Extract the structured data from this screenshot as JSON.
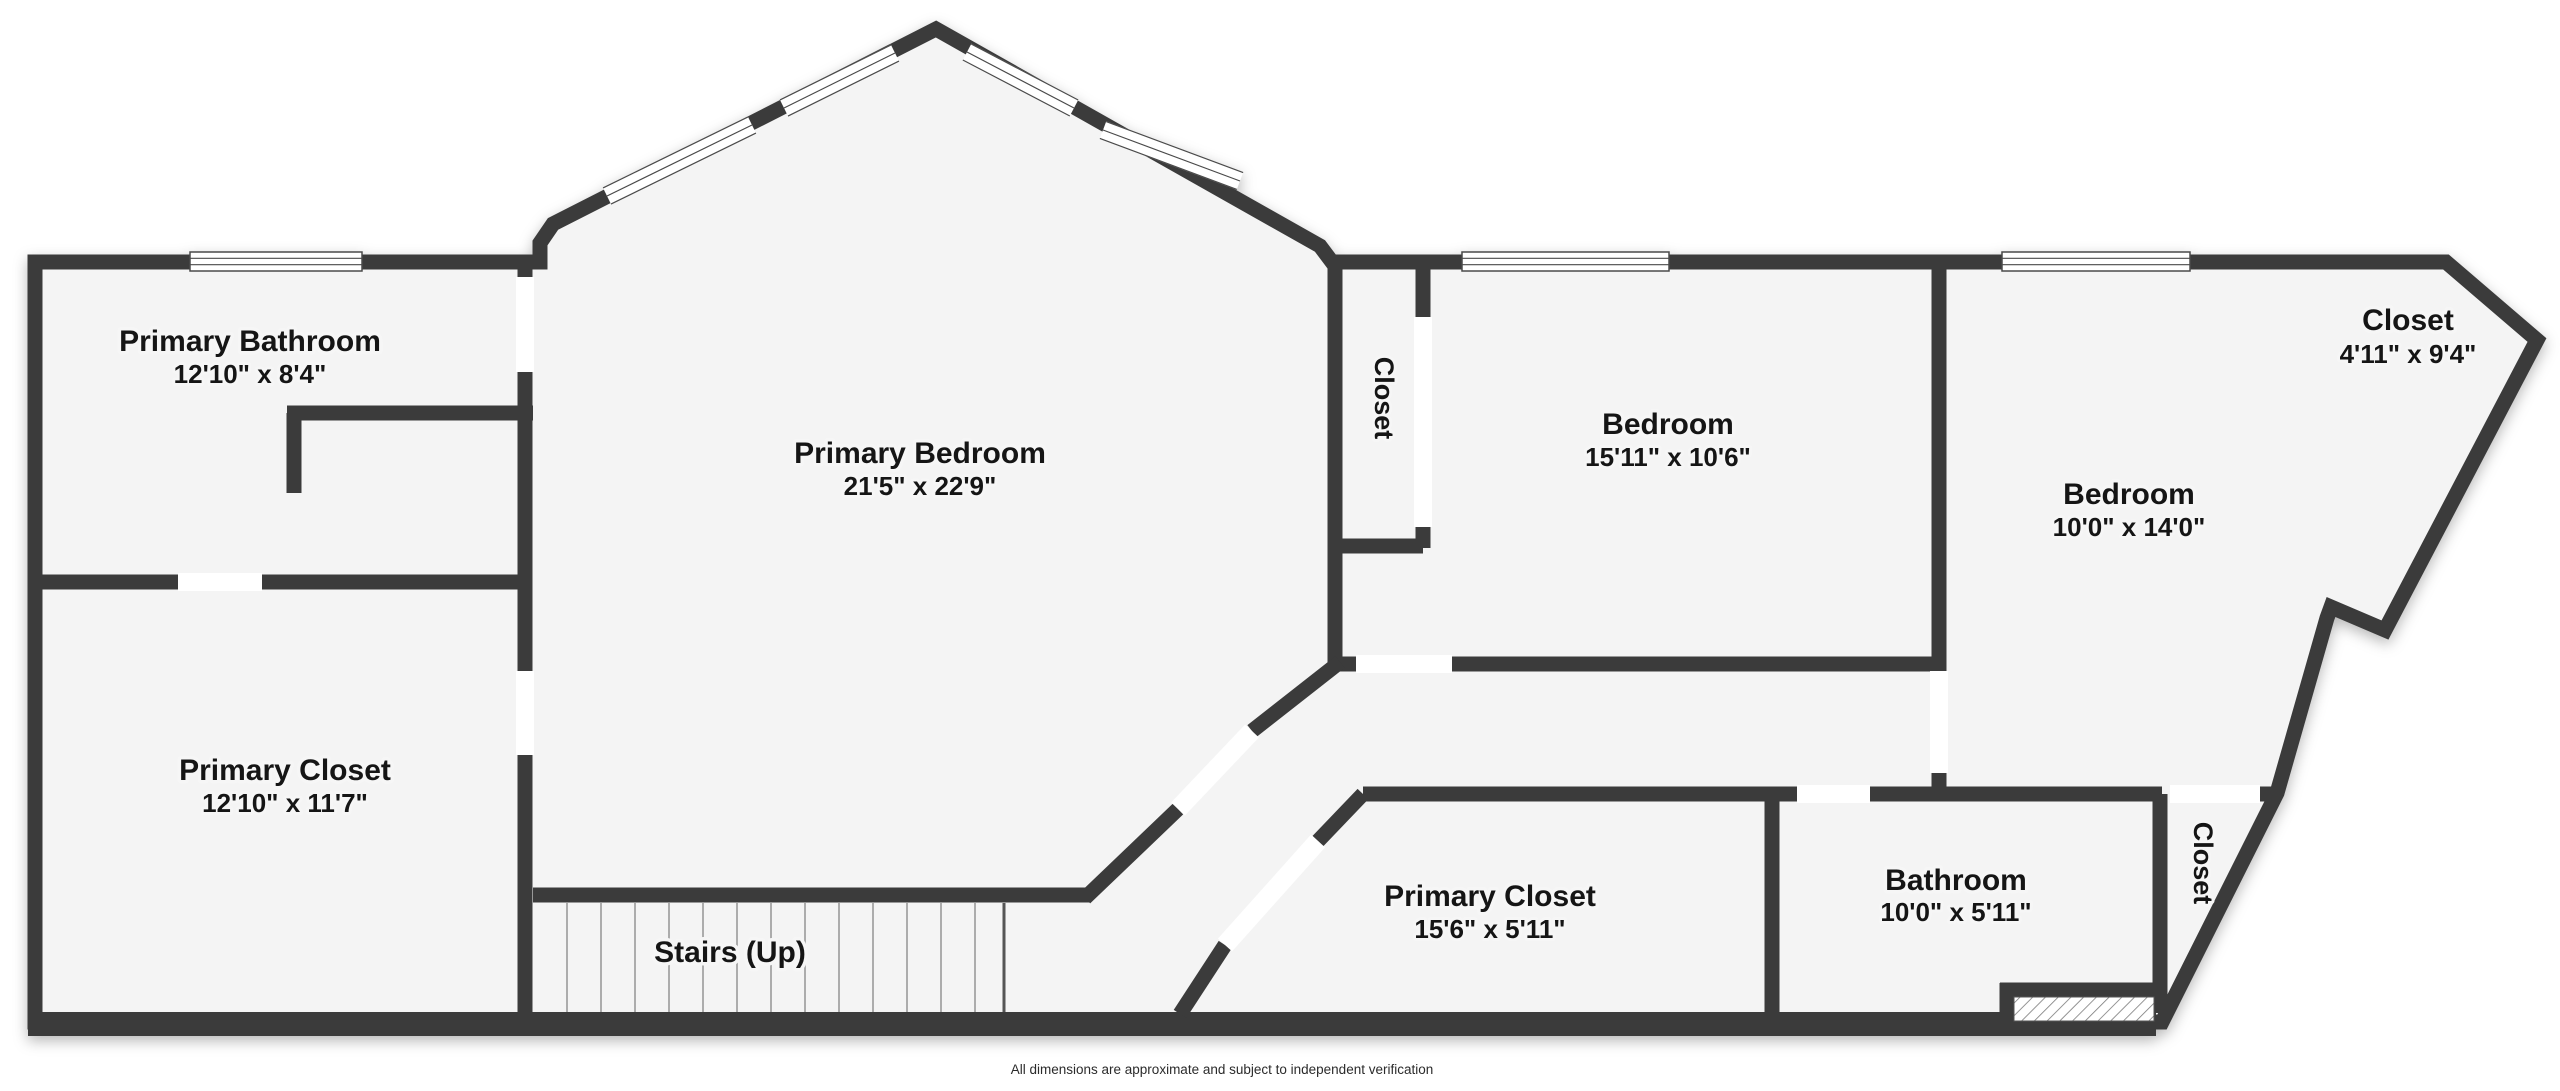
{
  "disclaimer": "All dimensions are approximate and subject to independent verification",
  "colors": {
    "background": "#ffffff",
    "floor": "#f4f4f4",
    "wall": "#3b3b3b",
    "window_line": "#4a4a4a",
    "tread_line": "#9a9a9a",
    "hatch_line": "#7a7a7a",
    "text": "#151515"
  },
  "rooms": [
    {
      "id": "primary-bathroom",
      "name": "Primary Bathroom",
      "dims": "12'10\" x 8'4\"",
      "x": 250,
      "y": 351,
      "dims_y": 383,
      "vertical": false
    },
    {
      "id": "primary-bedroom",
      "name": "Primary Bedroom",
      "dims": "21'5\" x 22'9\"",
      "x": 920,
      "y": 463,
      "dims_y": 495,
      "vertical": false
    },
    {
      "id": "primary-closet",
      "name": "Primary Closet",
      "dims": "12'10\" x 11'7\"",
      "x": 285,
      "y": 780,
      "dims_y": 812,
      "vertical": false
    },
    {
      "id": "stairs",
      "name": "Stairs (Up)",
      "dims": null,
      "x": 730,
      "y": 962,
      "dims_y": null,
      "vertical": false
    },
    {
      "id": "closet-hall",
      "name": "Closet",
      "dims": null,
      "x": 1375,
      "y": 398,
      "dims_y": null,
      "vertical": true
    },
    {
      "id": "bedroom-1",
      "name": "Bedroom",
      "dims": "15'11\" x 10'6\"",
      "x": 1668,
      "y": 434,
      "dims_y": 466,
      "vertical": false
    },
    {
      "id": "bedroom-2",
      "name": "Bedroom",
      "dims": "10'0\" x 14'0\"",
      "x": 2129,
      "y": 504,
      "dims_y": 536,
      "vertical": false
    },
    {
      "id": "closet-ne",
      "name": "Closet",
      "dims": "4'11\" x 9'4\"",
      "x": 2408,
      "y": 330,
      "dims_y": 363,
      "vertical": false
    },
    {
      "id": "bathroom",
      "name": "Bathroom",
      "dims": "10'0\" x 5'11\"",
      "x": 1956,
      "y": 890,
      "dims_y": 921,
      "vertical": false
    },
    {
      "id": "primary-closet-2",
      "name": "Primary Closet",
      "dims": "15'6\" x 5'11\"",
      "x": 1490,
      "y": 906,
      "dims_y": 938,
      "vertical": false
    },
    {
      "id": "closet-se",
      "name": "Closet",
      "dims": null,
      "x": 2194,
      "y": 863,
      "vertical": true
    }
  ],
  "floorplan": {
    "canvas": {
      "width": 2560,
      "height": 1091
    },
    "wall_width": 15,
    "outline": "M 35 262 L 540 262 L 540 243 L 553 224 L 936 29 L 1320 246 L 1332 262 L 2446 262 L 2537 340 L 2385 630 L 2331 607 L 2327 618 L 2277 793 L 2162 1022 L 35 1022 Z",
    "bottom_wall": {
      "x": 28,
      "y": 1012,
      "w": 2128,
      "h": 24
    },
    "walls": [
      {
        "x1": 525,
        "y1": 262,
        "x2": 525,
        "y2": 277
      },
      {
        "x1": 525,
        "y1": 372,
        "x2": 525,
        "y2": 671
      },
      {
        "x1": 525,
        "y1": 755,
        "x2": 525,
        "y2": 1013
      },
      {
        "x1": 287,
        "y1": 413,
        "x2": 533,
        "y2": 413
      },
      {
        "x1": 294,
        "y1": 413,
        "x2": 294,
        "y2": 493
      },
      {
        "x1": 35,
        "y1": 582,
        "x2": 178,
        "y2": 582
      },
      {
        "x1": 262,
        "y1": 582,
        "x2": 525,
        "y2": 582
      },
      {
        "x1": 1335,
        "y1": 262,
        "x2": 1335,
        "y2": 665
      },
      {
        "x1": 1423,
        "y1": 262,
        "x2": 1423,
        "y2": 317
      },
      {
        "x1": 1423,
        "y1": 527,
        "x2": 1423,
        "y2": 548
      },
      {
        "x1": 1335,
        "y1": 546,
        "x2": 1423,
        "y2": 546
      },
      {
        "x1": 1335,
        "y1": 664,
        "x2": 1356,
        "y2": 664
      },
      {
        "x1": 1452,
        "y1": 664,
        "x2": 1941,
        "y2": 664
      },
      {
        "x1": 1939,
        "y1": 262,
        "x2": 1939,
        "y2": 671
      },
      {
        "x1": 1939,
        "y1": 773,
        "x2": 1939,
        "y2": 800
      },
      {
        "x1": 1363,
        "y1": 794,
        "x2": 1797,
        "y2": 794
      },
      {
        "x1": 1870,
        "y1": 794,
        "x2": 2162,
        "y2": 794
      },
      {
        "x1": 2260,
        "y1": 794,
        "x2": 2278,
        "y2": 794
      },
      {
        "x1": 1772,
        "y1": 794,
        "x2": 1772,
        "y2": 1016
      },
      {
        "x1": 2160,
        "y1": 794,
        "x2": 2160,
        "y2": 1013
      },
      {
        "x1": 2000,
        "y1": 990,
        "x2": 2160,
        "y2": 990
      },
      {
        "x1": 2007,
        "y1": 983,
        "x2": 2007,
        "y2": 1018
      },
      {
        "x1": 1085,
        "y1": 898,
        "x2": 1178,
        "y2": 809
      },
      {
        "x1": 1252,
        "y1": 731,
        "x2": 1340,
        "y2": 662
      },
      {
        "x1": 1363,
        "y1": 794,
        "x2": 1318,
        "y2": 841
      },
      {
        "x1": 1225,
        "y1": 945,
        "x2": 1180,
        "y2": 1014
      },
      {
        "x1": 533,
        "y1": 895,
        "x2": 1090,
        "y2": 895
      }
    ],
    "doors": [
      {
        "x": 516,
        "y": 277,
        "w": 18,
        "h": 95
      },
      {
        "x": 516,
        "y": 671,
        "w": 18,
        "h": 84
      },
      {
        "x": 178,
        "y": 573,
        "w": 84,
        "h": 18
      },
      {
        "x": 1356,
        "y": 655,
        "w": 96,
        "h": 18
      },
      {
        "x": 1414,
        "y": 317,
        "w": 18,
        "h": 210
      },
      {
        "x": 1930,
        "y": 671,
        "w": 18,
        "h": 102
      },
      {
        "x": 1797,
        "y": 785,
        "w": 73,
        "h": 18
      },
      {
        "x": 2170,
        "y": 785,
        "w": 90,
        "h": 18
      }
    ],
    "diag_doors": [
      {
        "x1": 1178,
        "y1": 809,
        "x2": 1252,
        "y2": 731
      },
      {
        "x1": 1318,
        "y1": 841,
        "x2": 1225,
        "y2": 945
      }
    ],
    "windows": [
      {
        "x": 190,
        "y": 252,
        "w": 172,
        "h": 19
      },
      {
        "x": 1462,
        "y": 252,
        "w": 207,
        "h": 19
      },
      {
        "x": 2002,
        "y": 252,
        "w": 188,
        "h": 19
      }
    ],
    "slope_windows": [
      {
        "x1": 784,
        "y1": 108,
        "x2": 895,
        "y2": 53
      },
      {
        "x1": 607,
        "y1": 196,
        "x2": 752,
        "y2": 125
      },
      {
        "x1": 967,
        "y1": 52,
        "x2": 1074,
        "y2": 108
      },
      {
        "x1": 1103,
        "y1": 130,
        "x2": 1240,
        "y2": 181
      }
    ],
    "stairs": {
      "x1": 567,
      "step": 34,
      "count": 13,
      "y1": 903,
      "y2": 1012,
      "edge_x": 1004
    },
    "hatch": {
      "x": 2014,
      "y": 997,
      "w": 140,
      "h": 24
    }
  }
}
